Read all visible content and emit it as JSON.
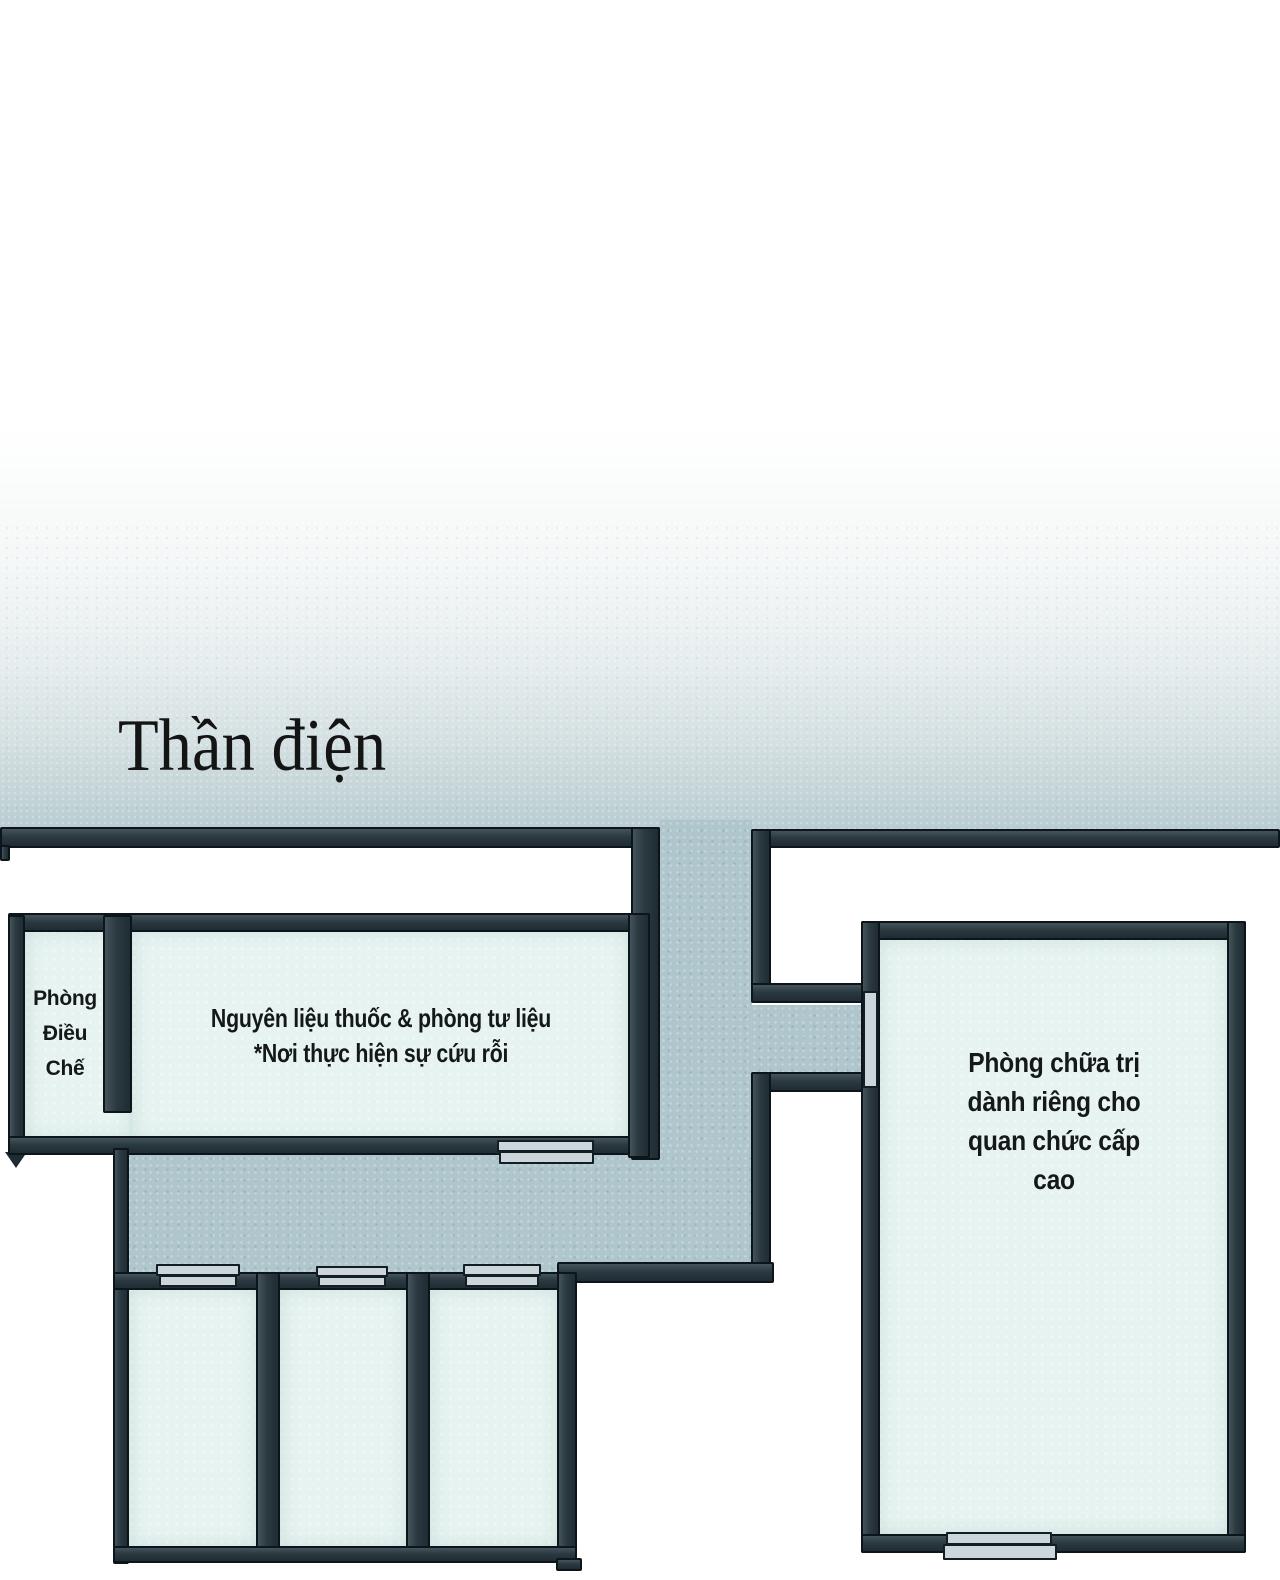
{
  "plan": {
    "title": "Thần điện",
    "rooms": {
      "preparation": {
        "lines": [
          "Phòng",
          "Điều",
          "Chế"
        ]
      },
      "materials": {
        "lines": [
          "Nguyên liệu thuốc & phòng tư liệu",
          "*Nơi thực hiện sự cứu rỗi"
        ]
      },
      "treatment": {
        "lines": [
          "Phòng chữa trị",
          "dành riêng cho",
          "quan chức cấp",
          "cao"
        ]
      }
    },
    "colors": {
      "wall": "#2b3941",
      "wall_outline": "#0c151a",
      "corridor": "#aec6cc",
      "room_interior": "#e7f3f0",
      "door": "#ccd5da",
      "background_fade": "#b9cdd2",
      "text": "#15181a"
    }
  }
}
